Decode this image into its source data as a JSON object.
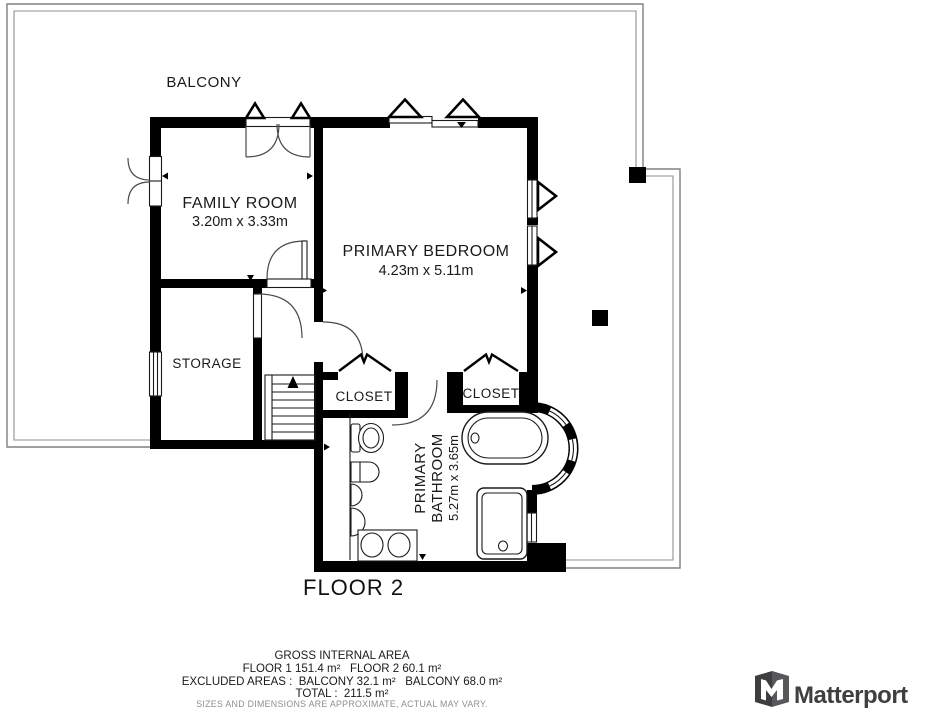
{
  "plan": {
    "floor_label": "FLOOR 2",
    "rooms": {
      "balcony": {
        "label": "BALCONY"
      },
      "family_room": {
        "label": "FAMILY ROOM",
        "dimensions": "3.20m x 3.33m"
      },
      "primary_bedroom": {
        "label": "PRIMARY BEDROOM",
        "dimensions": "4.23m x 5.11m"
      },
      "storage": {
        "label": "STORAGE"
      },
      "closet_left": {
        "label": "CLOSET"
      },
      "closet_right": {
        "label": "CLOSET"
      },
      "primary_bathroom": {
        "label_line1": "PRIMARY",
        "label_line2": "BATHROOM",
        "dimensions": "5.27m x 3.65m"
      }
    }
  },
  "footer": {
    "gross_internal_area_title": "GROSS INTERNAL AREA",
    "floors_line": "FLOOR 1 151.4 m²   FLOOR 2 60.1 m²",
    "excluded_line": "EXCLUDED AREAS :  BALCONY 32.1 m²   BALCONY 68.0 m²",
    "total_line": "TOTAL :  211.5 m²",
    "disclaimer": "SIZES AND DIMENSIONS ARE APPROXIMATE, ACTUAL MAY VARY."
  },
  "branding": {
    "logo_text": "Matterport"
  },
  "colors": {
    "wall": "#000000",
    "balcony_outline": "#818181",
    "text": "#1a1a1a",
    "disclaimer_text": "#8f8f8f",
    "logo": "#3f3f41"
  }
}
